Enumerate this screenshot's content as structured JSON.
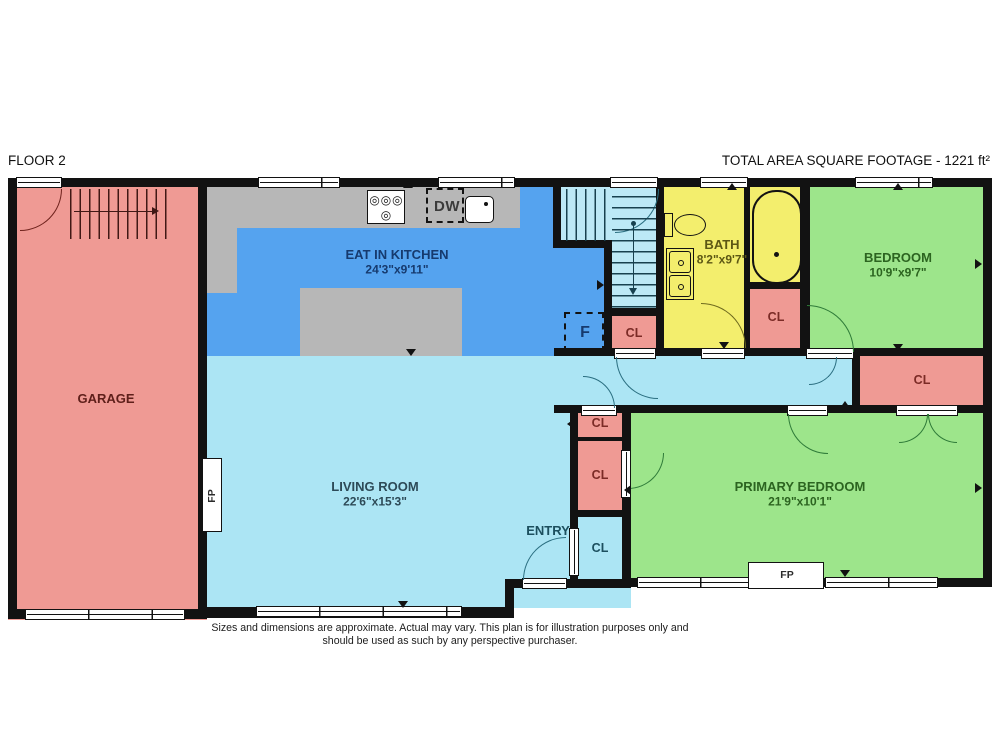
{
  "header": {
    "floor_label": "FLOOR 2",
    "total_area_label": "TOTAL AREA SQUARE FOOTAGE - 1221 ft²"
  },
  "rooms": {
    "garage": {
      "name": "GARAGE"
    },
    "kitchen": {
      "name": "EAT IN KITCHEN",
      "dims": "24'3\"x9'11\""
    },
    "living": {
      "name": "LIVING ROOM",
      "dims": "22'6\"x15'3\""
    },
    "bath": {
      "name": "BATH",
      "dims": "8'2\"x9'7\""
    },
    "bedroom": {
      "name": "BEDROOM",
      "dims": "10'9\"x9'7\""
    },
    "primary_bedroom": {
      "name": "PRIMARY BEDROOM",
      "dims": "21'9\"x10'1\""
    },
    "entry": {
      "name": "ENTRY"
    }
  },
  "labels": {
    "closet": "CL",
    "furnace": "F",
    "fireplace": "FP",
    "dishwasher": "DW"
  },
  "footer": {
    "line1": "Sizes and dimensions are approximate. Actual may vary. This plan is for illustration purposes only and",
    "line2": "should be used as such by any perspective purchaser."
  },
  "colors": {
    "garage_and_closets": "#ef9a94",
    "kitchen": "#55a3ef",
    "living_hall_entry": "#ace5f4",
    "stairs": "#bce9f6",
    "bath": "#f3ee6d",
    "bedrooms": "#9de58b",
    "counters": "#b7b7b7",
    "walls": "#121212"
  }
}
